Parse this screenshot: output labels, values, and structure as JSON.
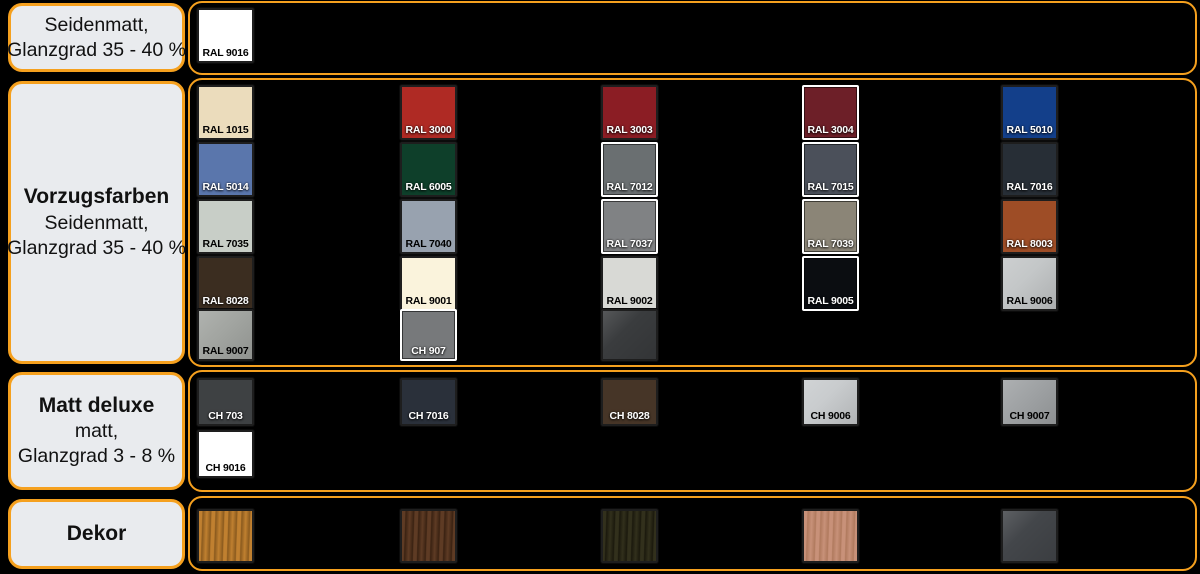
{
  "colors": {
    "background": "#000000",
    "accent_border": "#F5A01E",
    "label_box_bg": "#E9EBEE",
    "label_text": "#111111"
  },
  "sections": [
    {
      "id": "seidenmatt",
      "title": "",
      "lines": [
        "Seidenmatt,",
        "Glanzgrad 35 - 40 %"
      ],
      "swatches": [
        {
          "label": "RAL 9016",
          "color": "#FFFFFF",
          "text": "dark",
          "border": "dark",
          "col": 0,
          "row": 0
        }
      ]
    },
    {
      "id": "vorzugsfarben",
      "title": "Vorzugsfarben",
      "lines": [
        "Seidenmatt,",
        "Glanzgrad 35 - 40 %"
      ],
      "swatches": [
        {
          "label": "RAL 1015",
          "color": "#EBDCBC",
          "text": "dark",
          "border": "dark",
          "col": 0,
          "row": 0
        },
        {
          "label": "RAL 3000",
          "color": "#AF2A24",
          "text": "light",
          "border": "dark",
          "col": 1,
          "row": 0
        },
        {
          "label": "RAL 3003",
          "color": "#8B1D24",
          "text": "light",
          "border": "dark",
          "col": 2,
          "row": 0
        },
        {
          "label": "RAL 3004",
          "color": "#6D1F28",
          "text": "light",
          "border": "white",
          "col": 3,
          "row": 0
        },
        {
          "label": "RAL 5010",
          "color": "#133F8A",
          "text": "light",
          "border": "dark",
          "col": 4,
          "row": 0
        },
        {
          "label": "RAL 5014",
          "color": "#5A76AC",
          "text": "light",
          "border": "dark",
          "col": 0,
          "row": 1
        },
        {
          "label": "RAL 6005",
          "color": "#0E3F2A",
          "text": "light",
          "border": "dark",
          "col": 1,
          "row": 1
        },
        {
          "label": "RAL 7012",
          "color": "#6A6F71",
          "text": "light",
          "border": "white",
          "col": 2,
          "row": 1
        },
        {
          "label": "RAL 7015",
          "color": "#4B505A",
          "text": "light",
          "border": "white",
          "col": 3,
          "row": 1
        },
        {
          "label": "RAL 7016",
          "color": "#272E36",
          "text": "light",
          "border": "dark",
          "col": 4,
          "row": 1
        },
        {
          "label": "RAL 7035",
          "color": "#C8CEC7",
          "text": "dark",
          "border": "dark",
          "col": 0,
          "row": 2
        },
        {
          "label": "RAL 7040",
          "color": "#98A2AF",
          "text": "dark",
          "border": "dark",
          "col": 1,
          "row": 2
        },
        {
          "label": "RAL 7037",
          "color": "#808284",
          "text": "light",
          "border": "white",
          "col": 2,
          "row": 2
        },
        {
          "label": "RAL 7039",
          "color": "#8B8577",
          "text": "light",
          "border": "white",
          "col": 3,
          "row": 2
        },
        {
          "label": "RAL 8003",
          "color": "#9E4D26",
          "text": "light",
          "border": "dark",
          "col": 4,
          "row": 2
        },
        {
          "label": "RAL 8028",
          "color": "#3B2D20",
          "text": "light",
          "border": "dark",
          "col": 0,
          "row": 3
        },
        {
          "label": "RAL 9001",
          "color": "#FAF3DC",
          "text": "dark",
          "border": "dark",
          "col": 1,
          "row": 3
        },
        {
          "label": "RAL 9002",
          "color": "#D8D9D5",
          "text": "dark",
          "border": "dark",
          "col": 2,
          "row": 3
        },
        {
          "label": "RAL 9005",
          "color": "#0B0D11",
          "text": "light",
          "border": "white",
          "col": 3,
          "row": 3
        },
        {
          "label": "RAL 9006",
          "color": "#C4C7C8",
          "text": "dark",
          "border": "dark",
          "col": 4,
          "row": 3,
          "kind": "metal"
        },
        {
          "label": "RAL 9007",
          "color": "#A3A6A2",
          "text": "dark",
          "border": "dark",
          "col": 0,
          "row": 4,
          "kind": "metal"
        },
        {
          "label": "CH 907",
          "color": "#77797B",
          "text": "light",
          "border": "white",
          "col": 1,
          "row": 4
        },
        {
          "label": "",
          "color": "#3A3C3E",
          "text": "light",
          "border": "dark",
          "col": 2,
          "row": 4,
          "kind": "metal"
        }
      ]
    },
    {
      "id": "matt-deluxe",
      "title": "Matt deluxe",
      "lines": [
        "matt,",
        "Glanzgrad 3 - 8 %"
      ],
      "swatches": [
        {
          "label": "CH 703",
          "color": "#3E4143",
          "text": "light",
          "border": "dark",
          "col": 0,
          "row": 0
        },
        {
          "label": "CH 7016",
          "color": "#2A303A",
          "text": "light",
          "border": "dark",
          "col": 1,
          "row": 0
        },
        {
          "label": "CH 8028",
          "color": "#463527",
          "text": "light",
          "border": "dark",
          "col": 2,
          "row": 0
        },
        {
          "label": "CH 9006",
          "color": "#C9CCCE",
          "text": "dark",
          "border": "dark",
          "col": 3,
          "row": 0,
          "kind": "metal"
        },
        {
          "label": "CH 9007",
          "color": "#A0A3A5",
          "text": "dark",
          "border": "dark",
          "col": 4,
          "row": 0,
          "kind": "metal"
        },
        {
          "label": "CH 9016",
          "color": "#FFFFFF",
          "text": "dark",
          "border": "dark",
          "col": 0,
          "row": 1
        }
      ]
    },
    {
      "id": "dekor",
      "title": "Dekor",
      "lines": [],
      "swatches": [
        {
          "label": "",
          "kind": "wood",
          "colors": [
            "#C08030",
            "#8A5A1E"
          ],
          "border": "dark",
          "col": 0,
          "row": 0
        },
        {
          "label": "",
          "kind": "wood",
          "colors": [
            "#5E3B24",
            "#3A2212"
          ],
          "border": "dark",
          "col": 1,
          "row": 0
        },
        {
          "label": "",
          "kind": "wood",
          "colors": [
            "#32301C",
            "#1B190D"
          ],
          "border": "dark",
          "col": 2,
          "row": 0
        },
        {
          "label": "",
          "kind": "wood",
          "colors": [
            "#C89179",
            "#B07A5E"
          ],
          "border": "dark",
          "col": 3,
          "row": 0
        },
        {
          "label": "",
          "kind": "metal",
          "color": "#43464A",
          "border": "dark",
          "col": 4,
          "row": 0
        }
      ]
    }
  ]
}
